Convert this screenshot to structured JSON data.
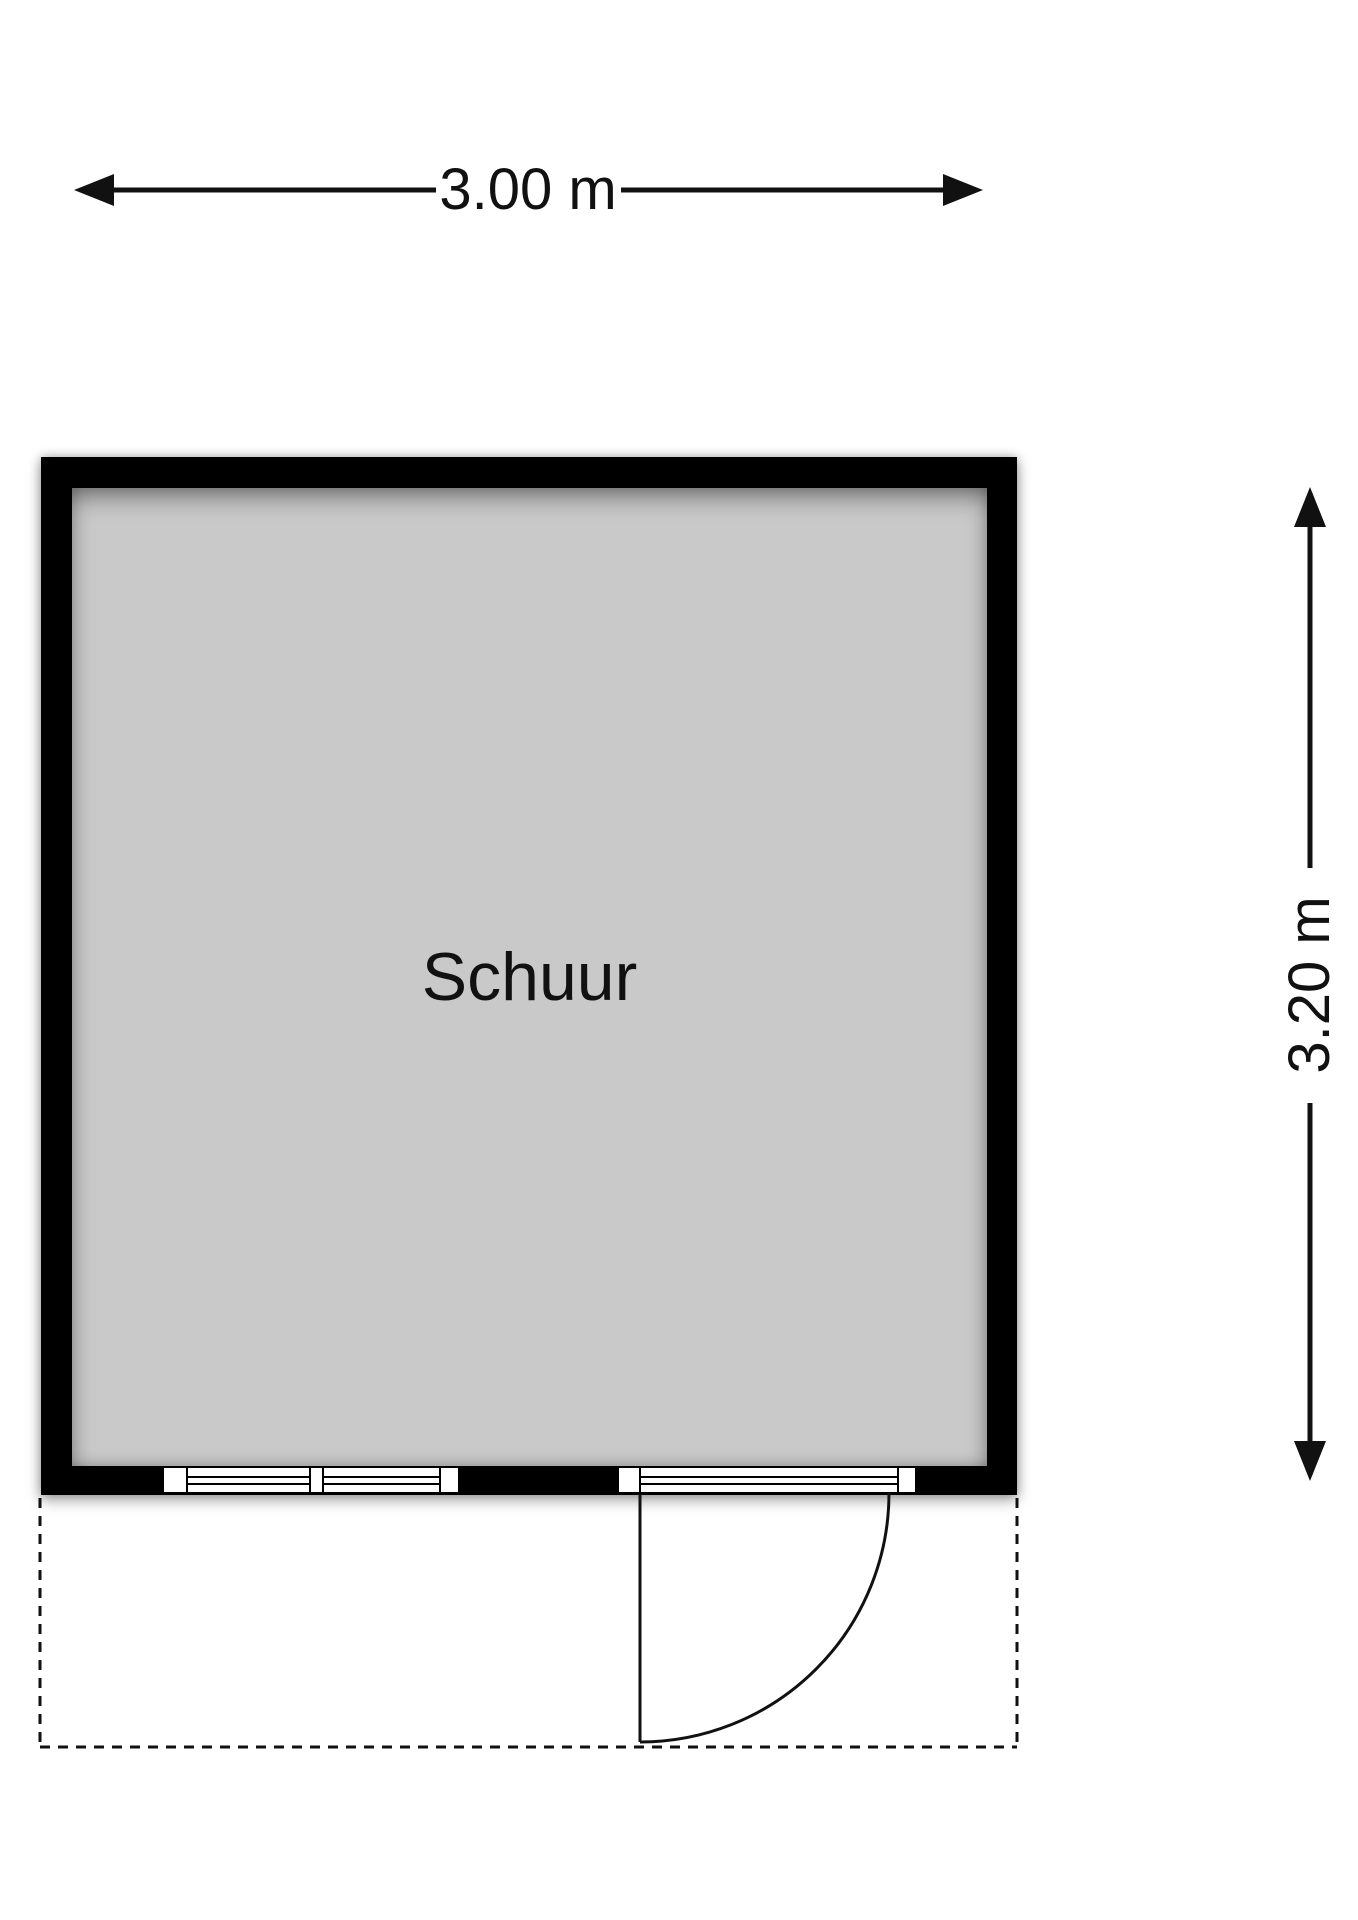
{
  "plan": {
    "room_label": "Schuur",
    "dimensions": {
      "width_label": "3.00 m",
      "height_label": "3.20 m"
    },
    "features": {
      "window_icon": "double casement window in bottom wall",
      "door_icon": "left-hinged door with outward quarter-circle swing",
      "canopy_icon": "dashed outline below bottom wall"
    }
  },
  "colors": {
    "wall": "#000000",
    "floor": "#c9c9c9",
    "linework": "#111111",
    "background": "#ffffff"
  }
}
